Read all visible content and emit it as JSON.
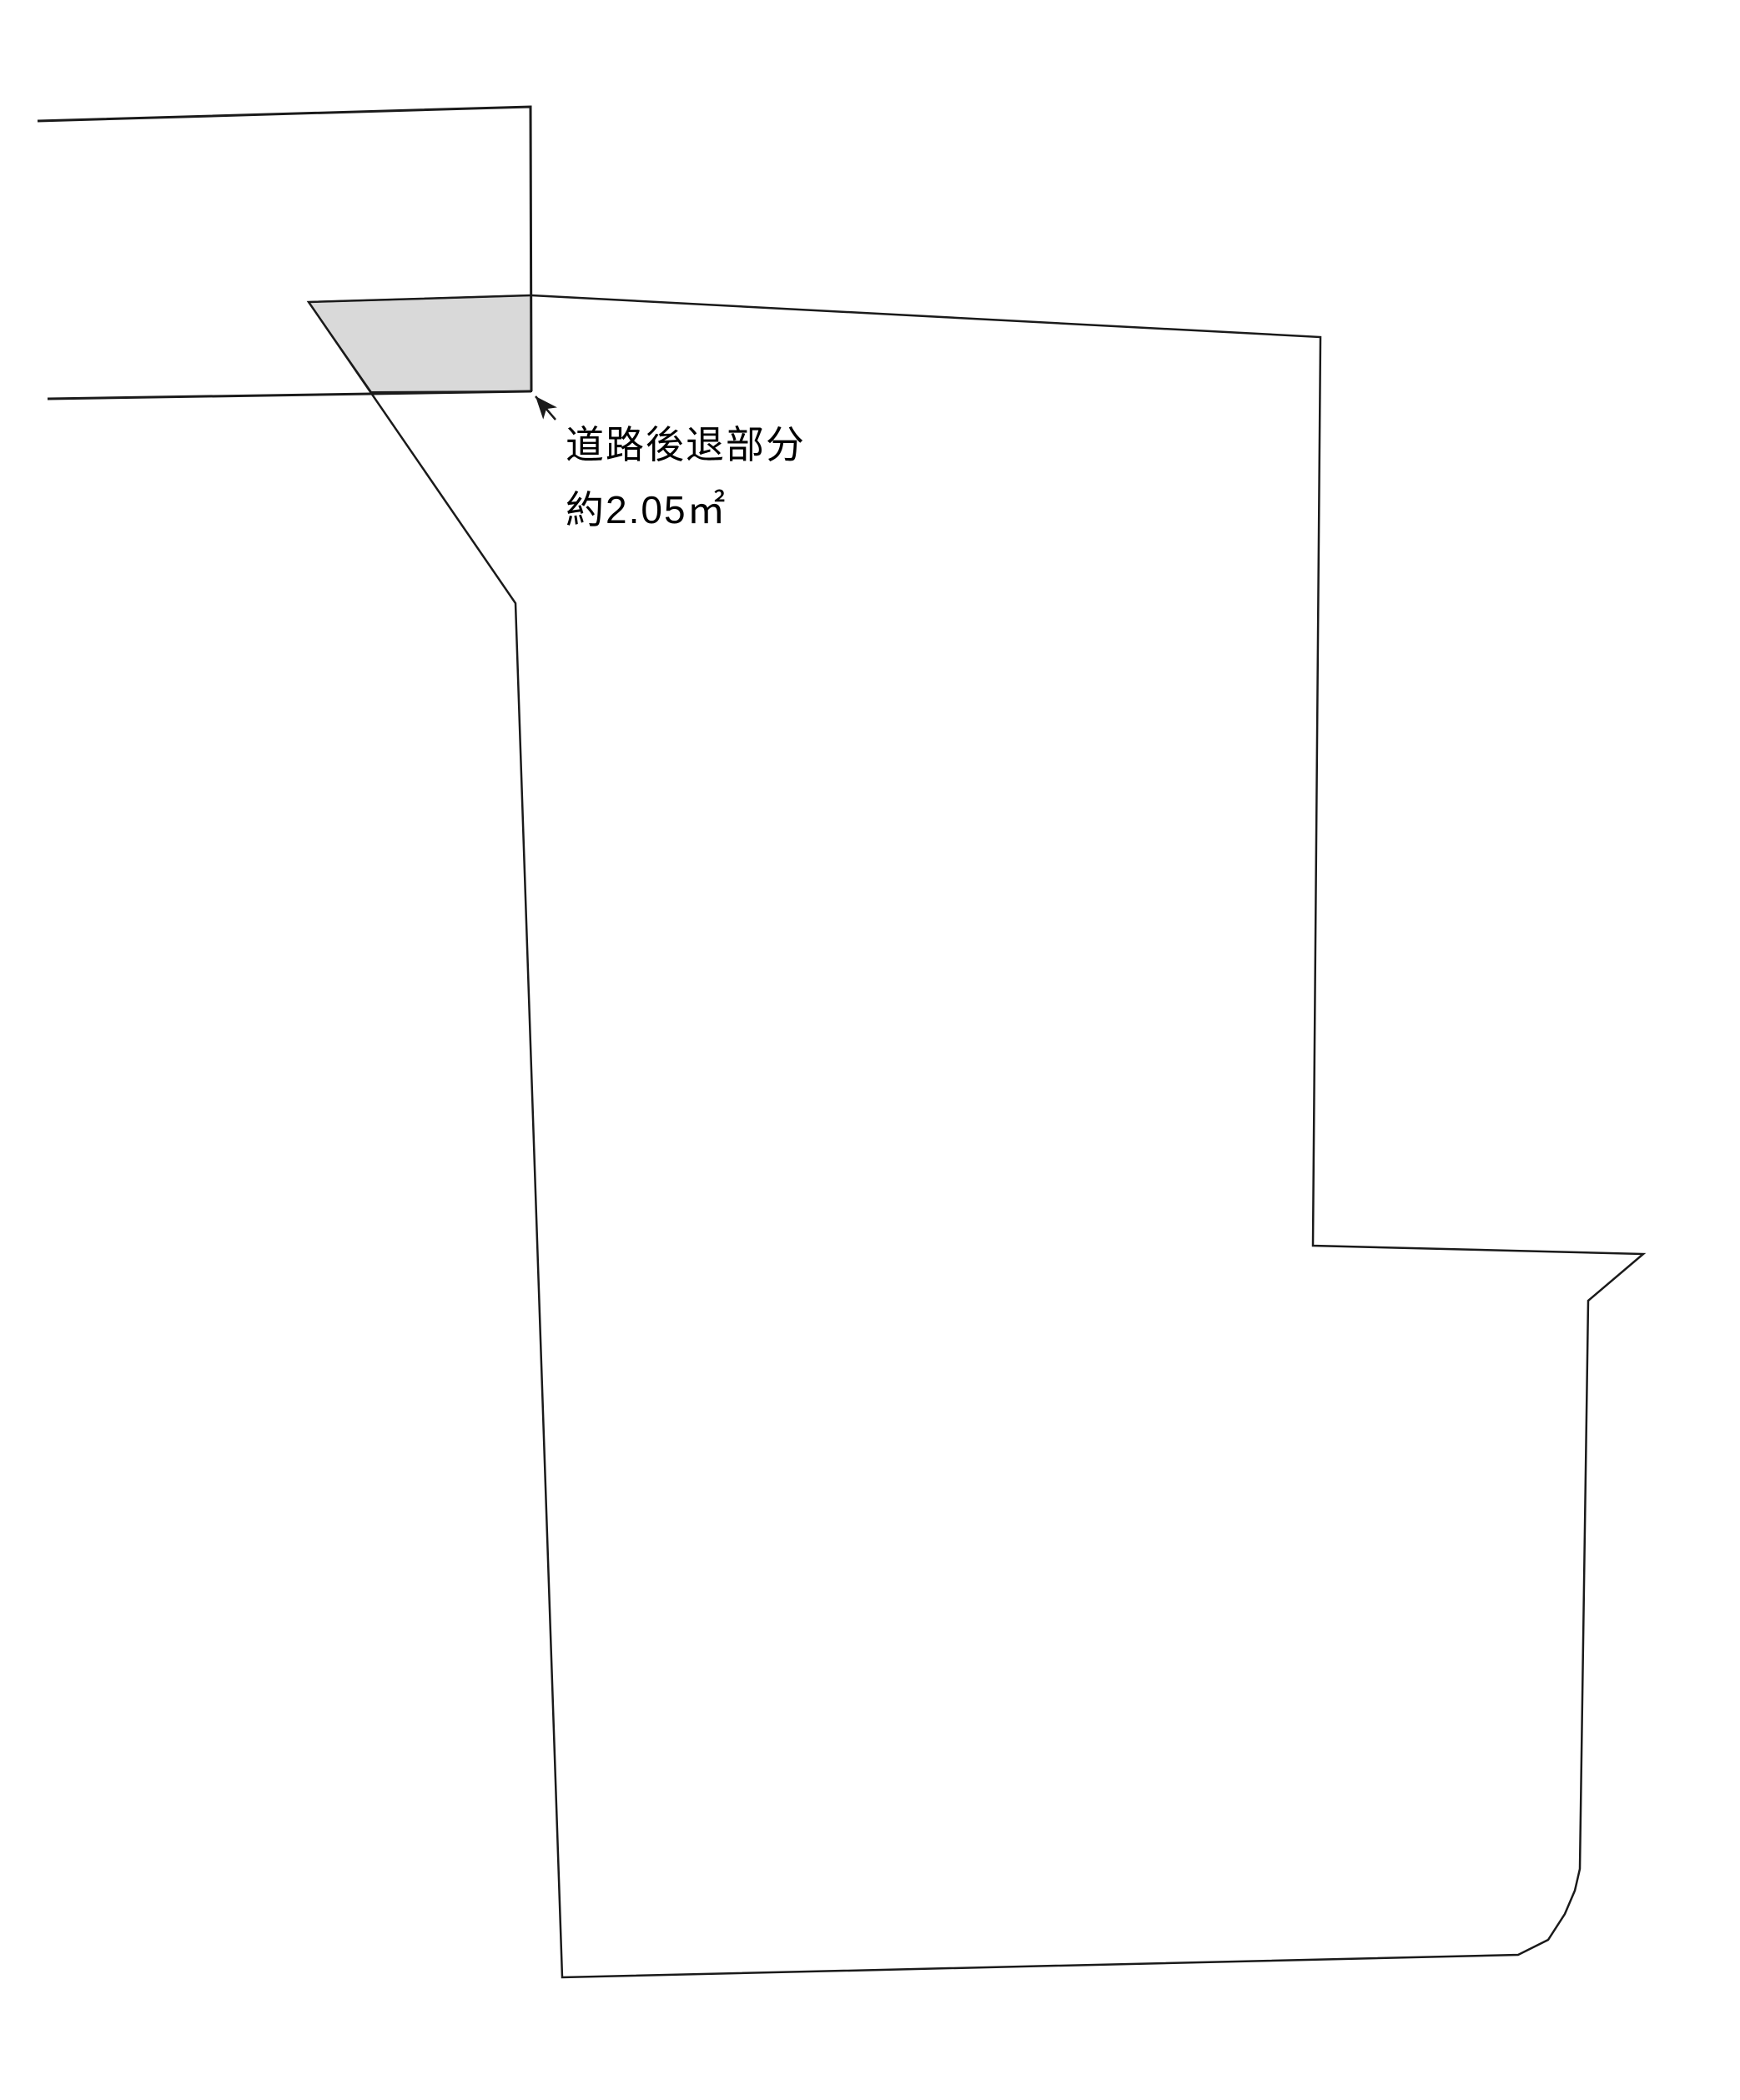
{
  "diagram": {
    "type": "land-survey-site-plan",
    "annotation": {
      "label_line1": "道路後退部分",
      "label_line2": "約2.05㎡",
      "approx_prefix": "約",
      "area_value": "2.05",
      "area_unit": "㎡",
      "meaning": "road setback portion"
    },
    "colors": {
      "line": "#1a1a1a",
      "setback_fill": "#d9d9d9",
      "background": "#ffffff"
    }
  }
}
